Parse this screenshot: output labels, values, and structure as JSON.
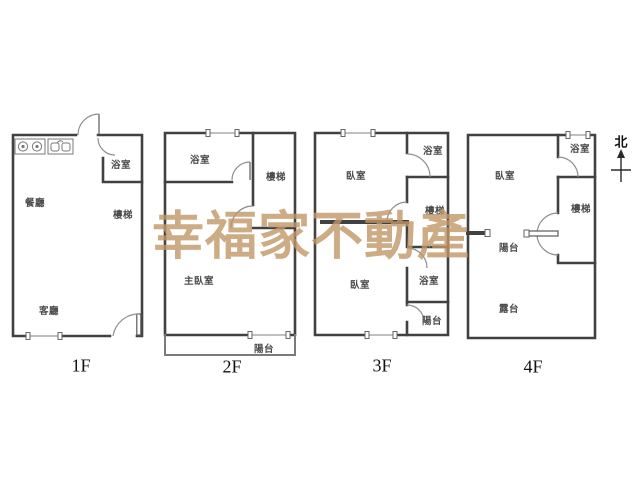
{
  "watermark": {
    "text": "幸福家不動產",
    "color": "#c09767"
  },
  "compass": {
    "label": "北",
    "icon": "north-arrow-icon"
  },
  "icons": {
    "stove": "stove-burners-icon",
    "sink": "kitchen-sink-icon",
    "north": "north-arrow-icon"
  },
  "floors": [
    {
      "label": "1F",
      "rooms": [
        {
          "name": "dining-room",
          "label": "餐廳"
        },
        {
          "name": "bathroom",
          "label": "浴室"
        },
        {
          "name": "stairs",
          "label": "樓梯"
        },
        {
          "name": "living-room",
          "label": "客廳"
        }
      ]
    },
    {
      "label": "2F",
      "rooms": [
        {
          "name": "bathroom",
          "label": "浴室"
        },
        {
          "name": "stairs",
          "label": "樓梯"
        },
        {
          "name": "master-bedroom",
          "label": "主臥室"
        },
        {
          "name": "balcony",
          "label": "陽台"
        }
      ]
    },
    {
      "label": "3F",
      "rooms": [
        {
          "name": "bedroom-front",
          "label": "臥室"
        },
        {
          "name": "bathroom-front",
          "label": "浴室"
        },
        {
          "name": "stairs",
          "label": "樓梯"
        },
        {
          "name": "bedroom-rear",
          "label": "臥室"
        },
        {
          "name": "bathroom-rear",
          "label": "浴室"
        },
        {
          "name": "balcony",
          "label": "陽台"
        }
      ]
    },
    {
      "label": "4F",
      "rooms": [
        {
          "name": "bedroom",
          "label": "臥室"
        },
        {
          "name": "bathroom",
          "label": "浴室"
        },
        {
          "name": "stairs",
          "label": "樓梯"
        },
        {
          "name": "balcony",
          "label": "陽台"
        },
        {
          "name": "terrace",
          "label": "露台"
        }
      ]
    }
  ]
}
